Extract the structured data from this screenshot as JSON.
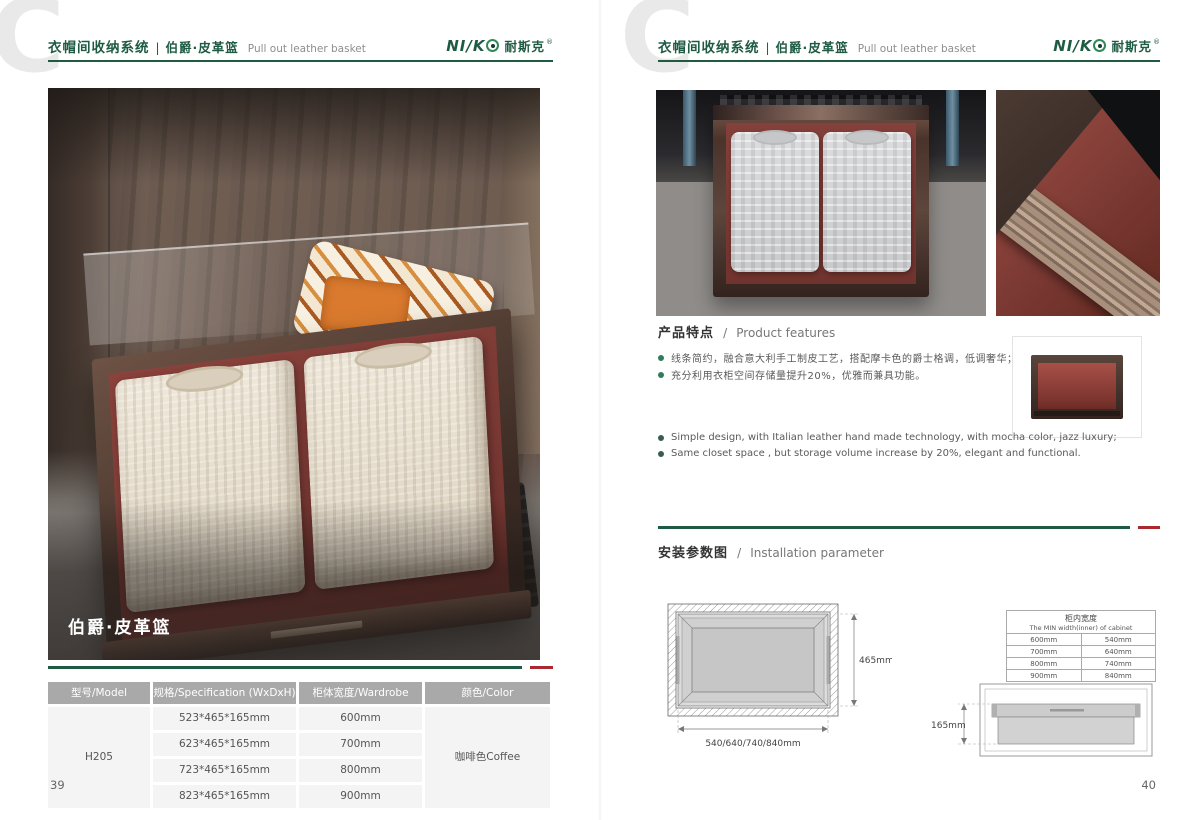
{
  "page": {
    "watermark_letter": "C"
  },
  "brand": {
    "logo_prefix": "NI/K",
    "logo_o": "O",
    "logo_cn": "耐斯克",
    "logo_reg": "®"
  },
  "header": {
    "system_cn": "衣帽间收纳系统",
    "divider": "|",
    "series_cn": "伯爵·皮革篮",
    "subtitle_en": "Pull out leather basket"
  },
  "colors": {
    "accent_green": "#1f5b43",
    "accent_red": "#a8292f",
    "table_header_gray": "#a9a9a9",
    "leather_red": "#7c3a34",
    "wood_brown": "#4a332b"
  },
  "left_page": {
    "photo_caption": "伯爵·皮革篮",
    "page_number": "39",
    "table": {
      "headers": [
        "型号/Model",
        "规格/Specification (WxDxH)",
        "柜体宽度/Wardrobe width",
        "颜色/Color"
      ],
      "model": "H205",
      "rows": [
        {
          "spec": "523*465*165mm",
          "width": "600mm"
        },
        {
          "spec": "623*465*165mm",
          "width": "700mm"
        },
        {
          "spec": "723*465*165mm",
          "width": "800mm"
        },
        {
          "spec": "823*465*165mm",
          "width": "900mm"
        }
      ],
      "color": "咖啡色Coffee"
    }
  },
  "right_page": {
    "page_number": "40",
    "features": {
      "title_cn": "产品特点",
      "title_sep": "/",
      "title_en": "Product features",
      "bullets_cn": [
        "线条简约，融合意大利手工制皮工艺，搭配摩卡色的爵士格调，低调奢华；",
        "充分利用衣柜空间存储量提升20%，优雅而兼具功能。"
      ],
      "bullets_en": [
        "Simple design, with Italian leather hand made technology, with mocha color, jazz luxury;",
        "Same closet space , but storage volume increase by 20%, elegant and functional."
      ]
    },
    "installation": {
      "title_cn": "安装参数图",
      "title_sep": "/",
      "title_en": "Installation parameter",
      "top_view": {
        "depth_label": "465mm",
        "width_label": "540/640/740/840mm"
      },
      "min_width_table": {
        "title_cn": "柜内宽度",
        "title_en": "The MIN width(inner) of cabinet",
        "rows": [
          [
            "600mm",
            "540mm"
          ],
          [
            "700mm",
            "640mm"
          ],
          [
            "800mm",
            "740mm"
          ],
          [
            "900mm",
            "840mm"
          ]
        ]
      },
      "front_view": {
        "height_label": "165mm"
      }
    }
  }
}
